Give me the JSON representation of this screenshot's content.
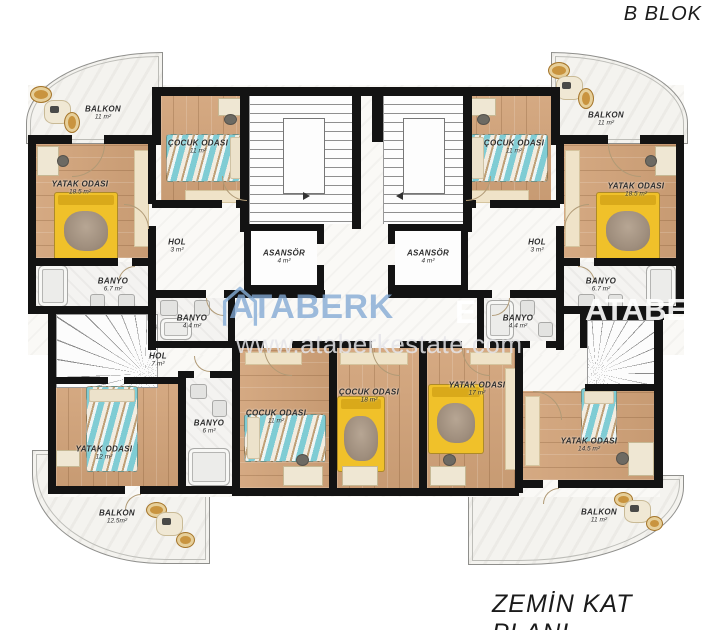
{
  "title": "B BLOK",
  "caption": "ZEMİN KAT PLANI",
  "watermark": {
    "brand": "ATABERK",
    "brand_echo": "ATABERK",
    "fragment": "E",
    "url": "www.ataberkestate.com"
  },
  "colors": {
    "wall": "#131313",
    "wood": "#d2a379",
    "tile": "#f4f3f1",
    "teal_bed": "#7fccd4",
    "yellow_bed": "#f0c12a",
    "watermark_blue": "#82a8d4",
    "balcony_chair": "#c9943f"
  },
  "rooms": [
    {
      "id": "tl-balkon",
      "label": "BALKON",
      "area": "11 m²"
    },
    {
      "id": "tl-cocuk",
      "label": "ÇOCUK ODASI",
      "area": "11 m²"
    },
    {
      "id": "tl-yatak",
      "label": "YATAK ODASI",
      "area": "18.5 m²"
    },
    {
      "id": "tl-hol",
      "label": "HOL",
      "area": "3 m²"
    },
    {
      "id": "tl-banyo",
      "label": "BANYO",
      "area": "6.7 m²"
    },
    {
      "id": "asansor-left",
      "label": "ASANSÖR",
      "area": "4 m²"
    },
    {
      "id": "asansor-right",
      "label": "ASANSÖR",
      "area": "4 m²"
    },
    {
      "id": "tr-cocuk",
      "label": "ÇOCUK ODASI",
      "area": "11 m²"
    },
    {
      "id": "tr-balkon",
      "label": "BALKON",
      "area": "11 m²"
    },
    {
      "id": "tr-yatak",
      "label": "YATAK ODASI",
      "area": "18.5 m²"
    },
    {
      "id": "tr-hol",
      "label": "HOL",
      "area": "3 m²"
    },
    {
      "id": "tr-banyo",
      "label": "BANYO",
      "area": "6.7 m²"
    },
    {
      "id": "ml-banyo",
      "label": "BANYO",
      "area": "4.4 m²"
    },
    {
      "id": "mr-banyo",
      "label": "BANYO",
      "area": "4.4 m²"
    },
    {
      "id": "bl-hol",
      "label": "HOL",
      "area": "7 m²"
    },
    {
      "id": "bl-yatak",
      "label": "YATAK ODASI",
      "area": "12 m²"
    },
    {
      "id": "bl-banyo",
      "label": "BANYO",
      "area": "6 m²"
    },
    {
      "id": "bl-cocuk",
      "label": "ÇOCUK ODASI",
      "area": "11 m²"
    },
    {
      "id": "bl-balkon",
      "label": "BALKON",
      "area": "12.5m²"
    },
    {
      "id": "bm-cocuk",
      "label": "ÇOCUK ODASI",
      "area": "18 m²"
    },
    {
      "id": "bm-yatak",
      "label": "YATAK ODASI",
      "area": "17 m²"
    },
    {
      "id": "br-yatak",
      "label": "YATAK ODASI",
      "area": "14.5 m²"
    },
    {
      "id": "br-balkon",
      "label": "BALKON",
      "area": "11 m²"
    }
  ]
}
